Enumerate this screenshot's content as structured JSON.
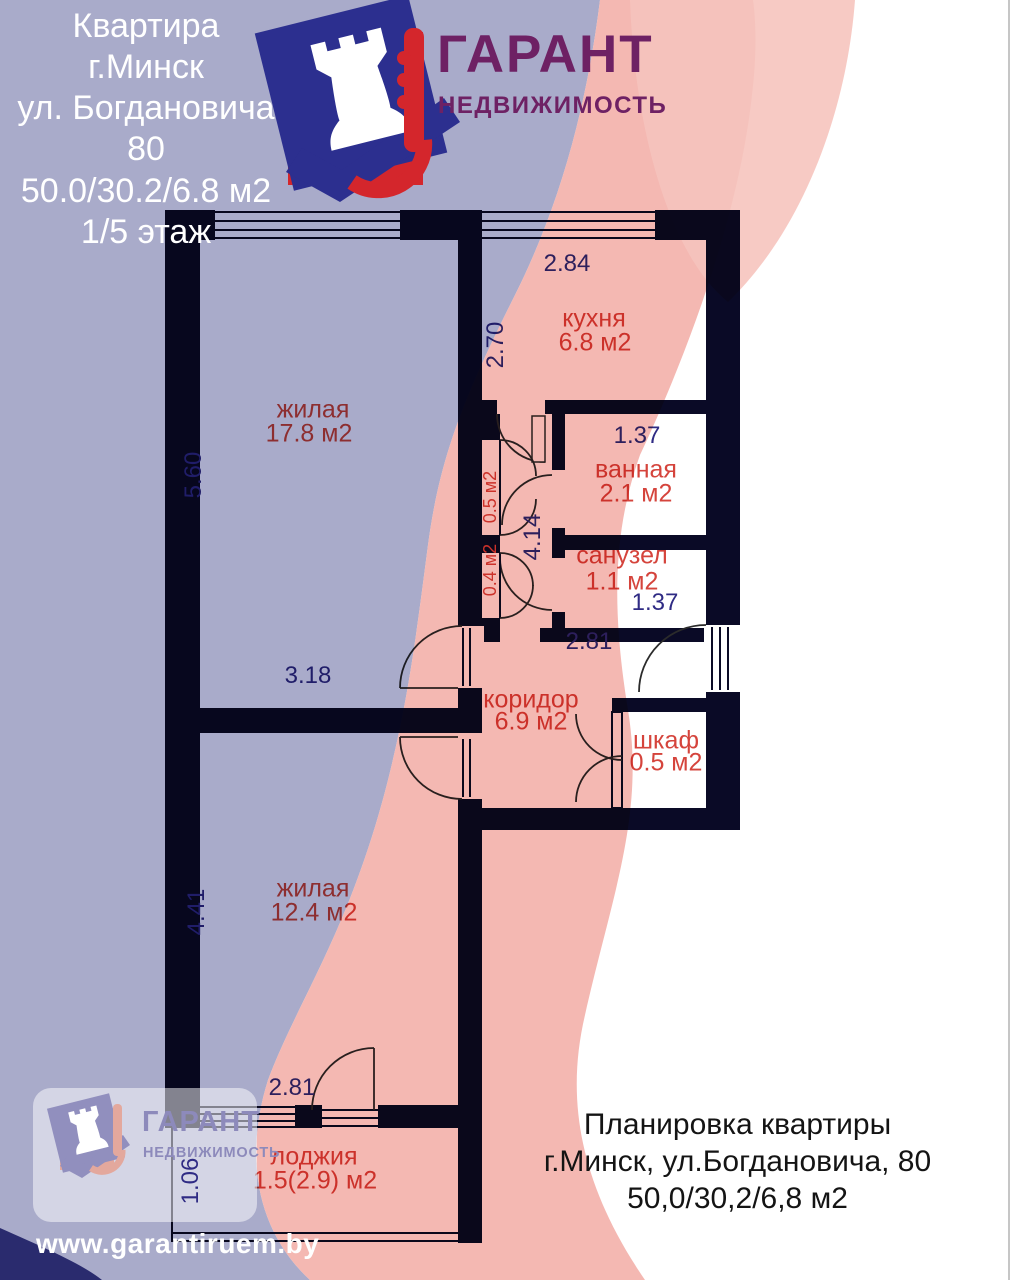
{
  "header": {
    "lines": [
      "Квартира",
      "г.Минск",
      "ул. Богдановича 80",
      "50.0/30.2/6.8 м2",
      "1/5 этаж"
    ]
  },
  "logo": {
    "name": "ГАРАНТ",
    "tagline": "НЕДВИЖИМОСТЬ"
  },
  "plan": {
    "rooms": [
      {
        "name": "жилая",
        "area": "17.8 м2"
      },
      {
        "name": "кухня",
        "area": "6.8 м2"
      },
      {
        "name": "ванная",
        "area": "2.1 м2"
      },
      {
        "name": "санузел",
        "area": "1.1 м2"
      },
      {
        "name": "коридор",
        "area": "6.9 м2"
      },
      {
        "name": "шкаф",
        "area": "0.5 м2"
      },
      {
        "name": "жилая",
        "area": "12.4 м2"
      },
      {
        "name": "лоджия",
        "area": "1.5(2.9) м2"
      }
    ],
    "niches": [
      {
        "area": "0.5 м2"
      },
      {
        "area": "0.4 м2"
      }
    ],
    "dimensions": {
      "kitchen_width": "2.84",
      "kitchen_depth": "2.70",
      "living1_height": "5.60",
      "bath_width": "1.37",
      "hall_height": "4.14",
      "wc_width": "1.37",
      "corridor_width": "2.81",
      "living1_width": "3.18",
      "living2_height": "4.41",
      "loggia_width": "2.81",
      "loggia_depth": "1.06"
    }
  },
  "footer": {
    "lines": [
      "Планировка квартиры",
      "г.Минск, ул.Богдановича, 80",
      "50,0/30,2/6,8 м2"
    ]
  },
  "website": "www.garantiruem.by",
  "colors": {
    "wall": "#0a0a26",
    "lavender": "#a9abca",
    "pink_band": "#f2aba4",
    "pink_light": "#f6c4be",
    "label_red": "#d5443c",
    "dim_blue": "#2f2b84",
    "logo_red": "#d4262c",
    "logo_navy": "#2c2f8f",
    "logo_purple": "#6e2164"
  }
}
